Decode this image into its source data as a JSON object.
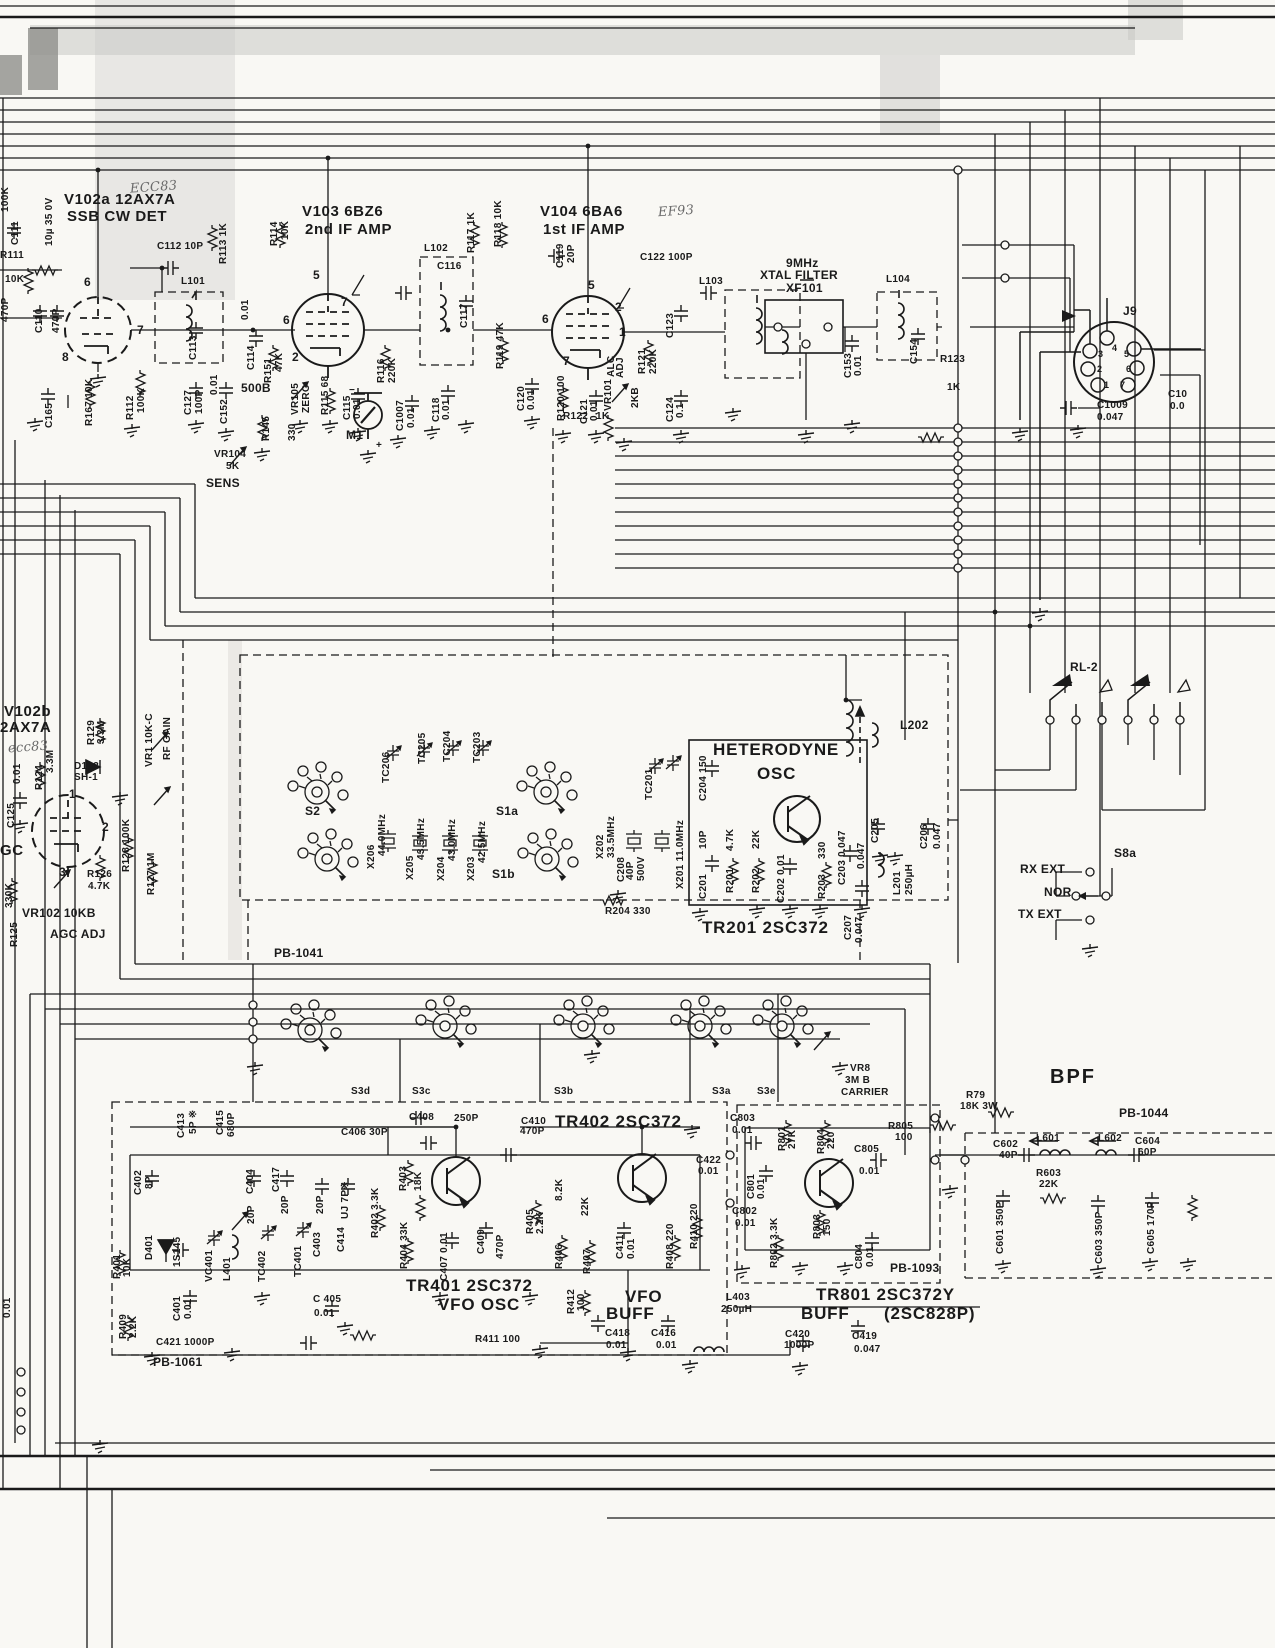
{
  "colors": {
    "ink": "#1a1a1a",
    "paper": "#f9f8f4",
    "scan_gray": "#c9c8c5"
  },
  "labels": {
    "ecc83_top": "ECC83",
    "ef93": "EF93",
    "ecc83_b": "ecc83",
    "v102a_1": "V102a 12AX7A",
    "v102a_2": "SSB CW DET",
    "v103_1": "V103  6BZ6",
    "v103_2": "2nd IF AMP",
    "v104_1": "V104  6BA6",
    "v104_2": "1st IF  AMP",
    "v102b_1": "V102b",
    "v102b_2": "2AX7A",
    "gc": "GC",
    "mu10": "10µ 35 0V",
    "c111": "C111",
    "k100": "100K",
    "p470L": "470P",
    "r111": "R111",
    "r111v": "10K",
    "c110": "C110",
    "p470": "470P",
    "c165": "C165",
    "r167": "R167 10K",
    "r112a": "R112",
    "r112b": "100K",
    "c112": "C112 10P",
    "l101": "L101",
    "c113": "C113",
    "c127a": "C127",
    "c127b": "100P",
    "c152a": "C152",
    "c152b": "0.01",
    "c114a": "C114",
    "c114b": "0.01",
    "r113": "R113 1K",
    "r114a": "R114",
    "r114b": "10K",
    "r151a": "R151",
    "r151b": "47K",
    "b500": "500B",
    "vr105a": "VR105",
    "vr105b": "ZERO",
    "r115": "R115 68",
    "c115a": "C115",
    "c115b": "0.01",
    "r145": "R145",
    "r145v": "330",
    "r116a": "R116",
    "r116b": "220K",
    "c1007a": "C1007",
    "c1007b": "0.01",
    "m1": "M1",
    "mplus": "+",
    "mminus": "−",
    "vr104": "VR104",
    "vr104v": "5K",
    "sens": "SENS",
    "c116": "C116",
    "l102": "L102",
    "c117": "C117",
    "c118a": "C118",
    "c118b": "0.01",
    "r117": "R117 1K",
    "r118": "R118 10K",
    "c119a": "C119",
    "c119b": "20P",
    "r119": "R119 47K",
    "c120a": "C120",
    "c120b": "0.01",
    "r120": "R120 100",
    "c121a": "C121",
    "c121b": "0.01",
    "alc1": "ALC",
    "alc2": "ADJ",
    "vr101": "VR101",
    "kb2": "2KB",
    "r121a": "R121",
    "r121b": "220K",
    "c124a": "C124",
    "c124b": "0.1",
    "r122": "R122",
    "r122v": "1K",
    "c122": "C122 100P",
    "l103": "L103",
    "c123": "C123",
    "mhz9": "9MHz",
    "xtalf": "XTAL FILTER",
    "xf101": "XF101",
    "c153a": "C153",
    "c153b": "0.01",
    "l104": "L104",
    "c154": "C154",
    "r123": "R123",
    "r123v": "1K",
    "j9": "J9",
    "c1009a": "C1009",
    "c1009b": "0.047",
    "c10x": "C10",
    "c10xv": "0.0",
    "p6a": "6",
    "p7a": "7",
    "p8a": "8",
    "p5b": "5",
    "p6b": "6",
    "p7b": "7",
    "p2b": "2",
    "p5c": "5",
    "p6c": "6",
    "p2c": "2",
    "p1c": "1",
    "p7c": "7",
    "p1d": "1",
    "p2d": "2",
    "p3d": "3",
    "j9p1": "1",
    "j9p2": "2",
    "j9p3": "3",
    "j9p4": "4",
    "j9p5": "5",
    "j9p6": "6",
    "j9p7": "7",
    "c125": "C125",
    "c125v": "0.01",
    "r124": "R124",
    "r124v": "3.3M",
    "r129": "R129",
    "r129v": "3.3M",
    "d103": "D103",
    "d103v": "SH-1",
    "vr1": "VR1 10K-C",
    "rfg": "RF GAIN",
    "r128": "R128 100K",
    "r127": "R127 1M",
    "r126": "R126",
    "r126v": "4.7K",
    "vr102": "VR102 10KB",
    "agcadj": "AGC ADJ",
    "k330": "330K",
    "r125": "R125",
    "het1": "HETERODYNE",
    "het2": "OSC",
    "tr201": "TR201 2SC372",
    "pb1041": "PB-1041",
    "s2": "S2",
    "s1a": "S1a",
    "s1b": "S1b",
    "tc206": "TC206",
    "tc205": "TC205",
    "tc204": "TC204",
    "tc203": "TC203",
    "tc201": "TC201",
    "x206": "X206",
    "x206v": "44.0MHz",
    "x205": "X205",
    "x205v": "43.5MHz",
    "x204": "X204",
    "x204v": "43.0MHz",
    "x203": "X203",
    "x203v": "42.5MHz",
    "x202": "X202",
    "x202v": "33.5MHz",
    "c208": "C208",
    "c208v": "40P",
    "v500": "500V",
    "x201": "X201 11.0MHz",
    "c204": "C204 150",
    "r204": "R204 330",
    "c201": "C201",
    "c201v": "10P",
    "r201": "R201",
    "r201v": "4.7K",
    "r202": "R202",
    "r202v": "22K",
    "c202": "C202 0.01",
    "r203": "R203",
    "r203v": "330",
    "c203": "C203 0.047",
    "f047": "0.047",
    "c205": "C205",
    "c206": "C206",
    "c206v": "0.047",
    "l201": "L201",
    "l201v": "250µH",
    "l202": "L202",
    "c207": "C207",
    "c207v": "0.047",
    "rl2": "RL-2",
    "s8a": "S8a",
    "rxext": "RX EXT",
    "nor": "NOR",
    "txext": "TX EXT",
    "s3d": "S3d",
    "s3c": "S3c",
    "s3b": "S3b",
    "s3a": "S3a",
    "s3e": "S3e",
    "vr8_1": "VR8",
    "vr8_2": "3M B",
    "vr8_3": "CARRIER",
    "r79_1": "R79",
    "r79_2": "18K 3W",
    "bpf": "BPF",
    "pb1044": "PB-1044",
    "c602a": "C602",
    "c602b": "40P",
    "l601": "L601",
    "l602": "L602",
    "c604a": "C604",
    "c604b": "60P",
    "r603a": "R603",
    "r603b": "22K",
    "c601": "C601 350P",
    "c603": "C603 350P",
    "c605": "C605 170P",
    "c413": "C413",
    "c413v": "5P ※",
    "c415": "C415",
    "c415v": "680P",
    "c402": "C402",
    "c402v": "8P",
    "c406": "C406 30P",
    "c408a": "C408",
    "c408b": "250P",
    "c410a": "C410",
    "c410b": "470P",
    "tr402": "TR402 2SC372",
    "r401": "R401",
    "r401v": "10K",
    "d401": "D401",
    "s145": "1S145",
    "vc401": "VC401",
    "l401": "L401",
    "tc402": "TC402",
    "tc401": "TC401",
    "c404": "C404",
    "c404v": "20P",
    "c417": "C417",
    "c417v": "20P",
    "c403": "C403",
    "c403v": "20P",
    "c414": "C414",
    "c414v": "UJ 7P※",
    "r402": "R402 3.3K",
    "r403": "R403",
    "r403v": "18K",
    "r404": "R404 33K",
    "c407": "C407 0.01",
    "c409": "C409",
    "c409v": "470P",
    "r405": "R405",
    "r405v": "2.2K",
    "r406": "R406",
    "r406v": "8.2K",
    "r407": "R407",
    "r407v": "22K",
    "c411": "C411",
    "c411v": "0.01",
    "r408": "R408 220",
    "r410": "R410 220",
    "r412": "R412",
    "r412v": "100",
    "c422a": "C422",
    "c422b": "0.01",
    "tr401_1": "TR401 2SC372",
    "tr401_2": "VFO OSC",
    "vfob1": "VFO",
    "vfob2": "BUFF",
    "r411": "R411 100",
    "c405a": "C 405",
    "c405b": "0.01",
    "c401": "C401",
    "c401v": "0.01",
    "r409": "R409",
    "r409v": "2.2K",
    "c421": "C421 1000P",
    "pb1061": "PB-1061",
    "e001": "0.01",
    "c418a": "C418",
    "c418b": "0.01",
    "c416a": "C416",
    "c416b": "0.01",
    "c803a": "C803",
    "c803b": "0.01",
    "r801": "R801",
    "r801v": "27K",
    "r804": "R804",
    "r804v": "220",
    "r805a": "R805",
    "r805b": "100",
    "c805a": "C805",
    "c805b": "0.01",
    "c801": "C801",
    "c801v": "0.01",
    "c802a": "C802",
    "c802b": "0.01",
    "r802": "R802 3.3K",
    "r803": "R803",
    "r803v": "150",
    "c804": "C804",
    "c804v": "0.01",
    "pb1093": "PB-1093",
    "tr801_1": "TR801 2SC372Y",
    "tr801_2": "BUFF",
    "tr801_3": "(2SC828P)",
    "l403a": "L403",
    "l403b": "250µH",
    "c420a": "C420",
    "c420b": "1000P",
    "c419a": "C419",
    "c419b": "0.047"
  }
}
